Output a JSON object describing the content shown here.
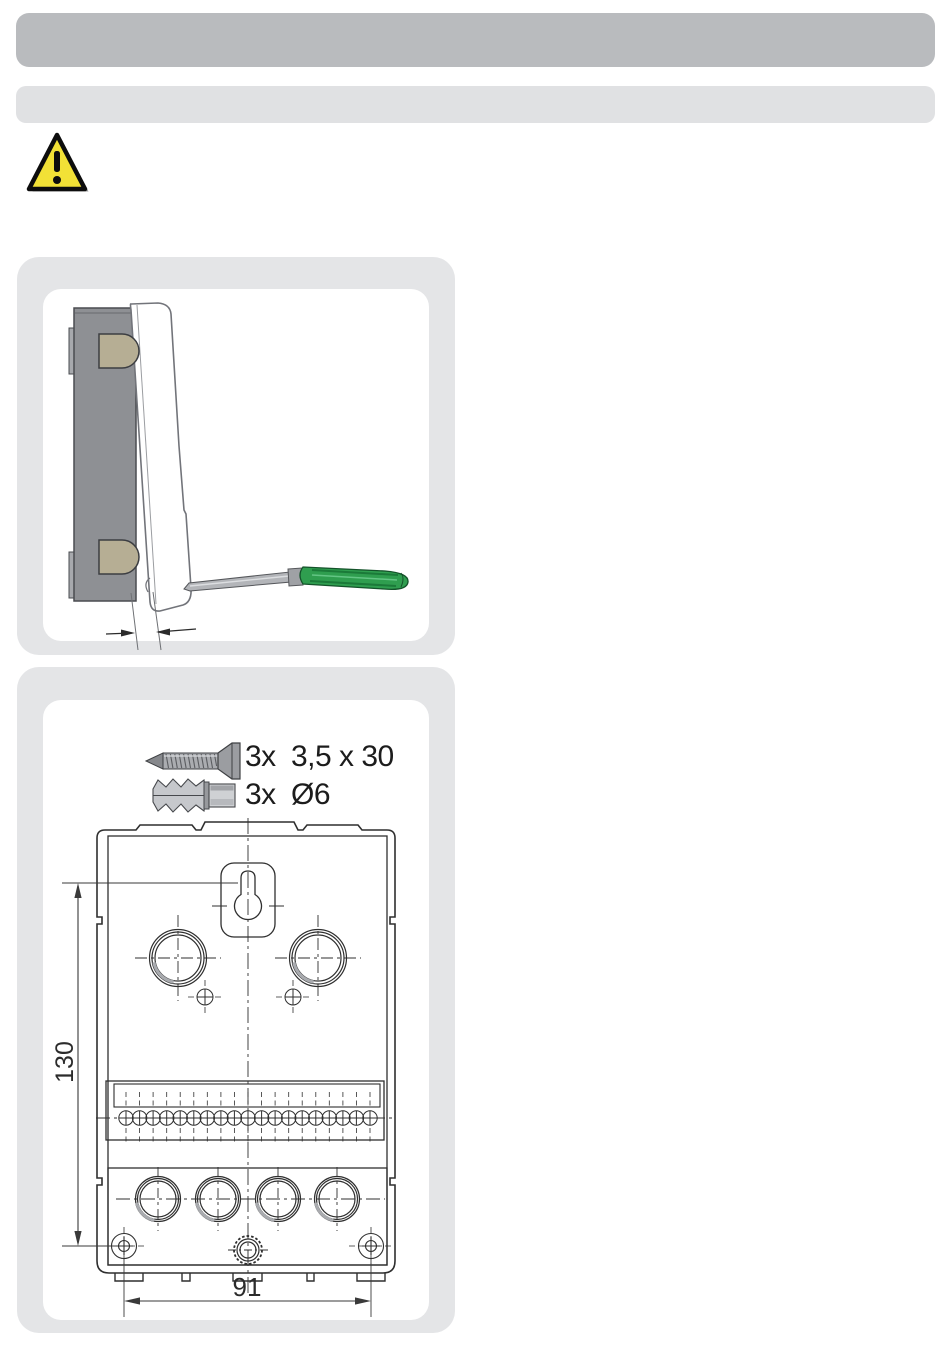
{
  "page": {
    "background": "#ffffff",
    "description": "installation manual page with cover-opening step and wall-mounting drawing"
  },
  "header": {
    "bar_primary_color": "#b9bbbe",
    "bar_secondary_color": "#e0e1e3"
  },
  "warning": {
    "icon": "warning-triangle-icon",
    "fill": "#f2e136",
    "stroke": "#0d0d0d"
  },
  "panel_cover_removal": {
    "background": "#e4e5e7",
    "inner_background": "#ffffff",
    "illustration": "device-side-view-cover-pried-open-with-screwdriver",
    "colors": {
      "device_body": "#8e9094",
      "mounting_clips": "#b6ae94",
      "screwdriver_handle": "#2f9e4f",
      "screwdriver_shaft": "#b3b5b9"
    }
  },
  "panel_mounting": {
    "background": "#e4e5e7",
    "inner_background": "#ffffff",
    "hardware": [
      {
        "icon": "screw-icon",
        "qty": "3x",
        "spec": "3,5 x 30"
      },
      {
        "icon": "wall-plug-icon",
        "qty": "3x",
        "spec": "Ø6"
      }
    ],
    "drawing": {
      "name": "rear-mounting-drawing",
      "terminal_count": 19,
      "knockouts_top": 2,
      "knockouts_bottom": 4,
      "dim_height_mm": "130",
      "dim_width_mm": "91",
      "line_color": "#2f2f2f"
    }
  }
}
